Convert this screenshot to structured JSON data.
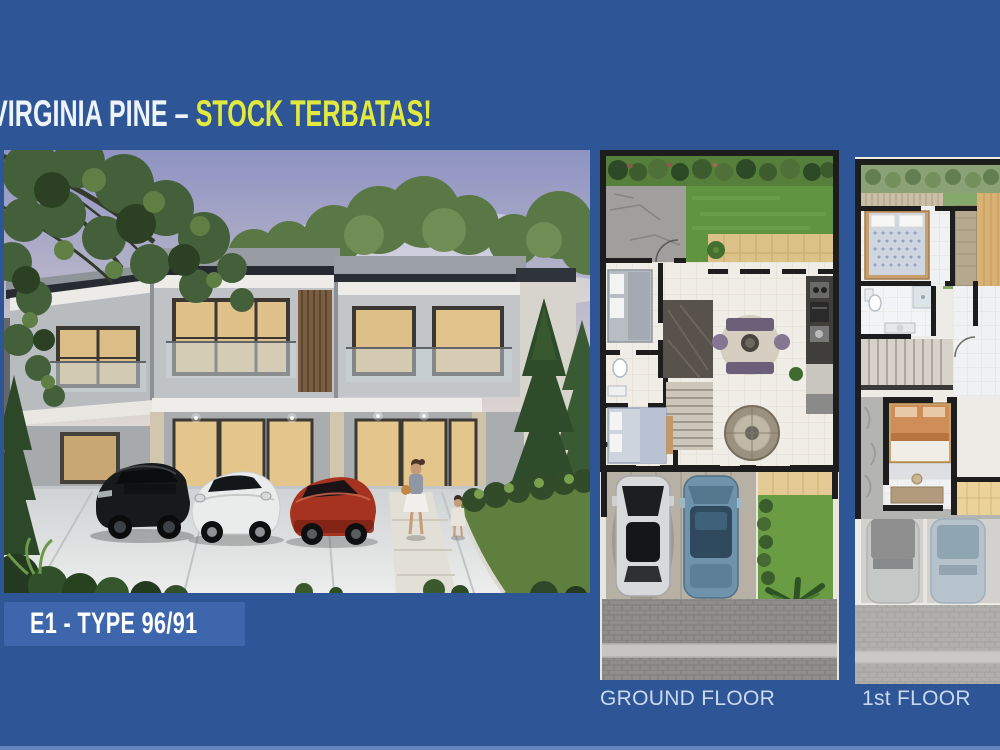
{
  "slide": {
    "background_color": "#2e5596",
    "bottom_strip_color": "#6583bd"
  },
  "title": {
    "white_part": "VIRGINIA PINE – ",
    "yellow_part": "STOCK TERBATAS!",
    "white_color": "#eef3f9",
    "yellow_color": "#e2e93f"
  },
  "badge": {
    "label": "E1 - TYPE 96/91",
    "background_color": "#3e66ac",
    "text_color": "#ffffff"
  },
  "floorplans": {
    "ground": {
      "label": "GROUND FLOOR"
    },
    "first": {
      "label": "1st FLOOR"
    },
    "label_color": "#c9daee"
  }
}
